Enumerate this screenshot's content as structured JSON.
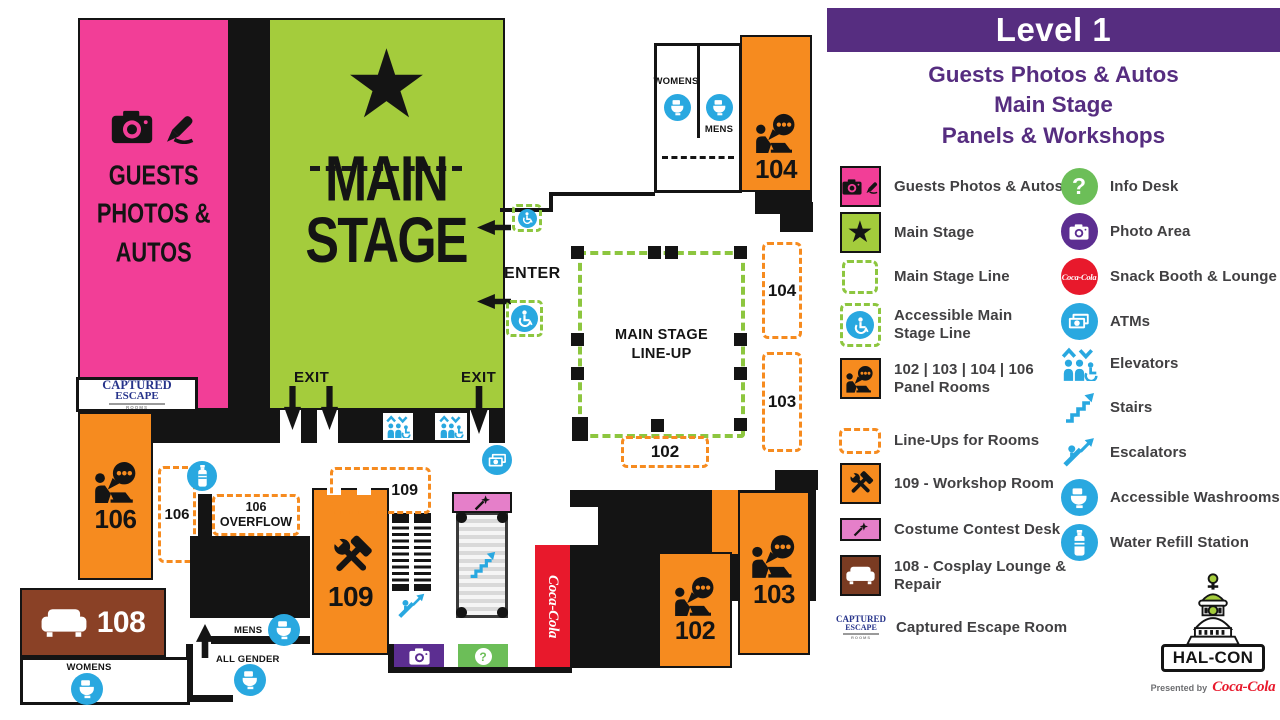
{
  "header": {
    "title": "Level 1",
    "subtitle": "Guests Photos & Autos\nMain Stage\nPanels & Workshops"
  },
  "legend": {
    "left": [
      {
        "icon": "guests-photos-autos",
        "label": "Guests Photos & Autos"
      },
      {
        "icon": "main-stage",
        "label": "Main Stage"
      },
      {
        "icon": "main-stage-line",
        "label": "Main Stage Line"
      },
      {
        "icon": "accessible-main-stage-line",
        "label": "Accessible Main\nStage Line"
      },
      {
        "icon": "panel-rooms",
        "label": "102 | 103 | 104 | 106\nPanel Rooms"
      },
      {
        "icon": "line-ups",
        "label": "Line-Ups for Rooms"
      },
      {
        "icon": "workshop-room",
        "label": "109 - Workshop Room"
      },
      {
        "icon": "costume-contest-desk",
        "label": "Costume Contest Desk"
      },
      {
        "icon": "cosplay-lounge",
        "label": "108 - Cosplay Lounge &\nRepair"
      },
      {
        "icon": "captured-escape",
        "label": "Captured Escape Room"
      }
    ],
    "right": [
      {
        "icon": "info-desk",
        "label": "Info Desk"
      },
      {
        "icon": "photo-area",
        "label": "Photo Area"
      },
      {
        "icon": "snack-booth",
        "label": "Snack Booth & Lounge"
      },
      {
        "icon": "atms",
        "label": "ATMs"
      },
      {
        "icon": "elevators",
        "label": "Elevators"
      },
      {
        "icon": "stairs",
        "label": "Stairs"
      },
      {
        "icon": "escalators",
        "label": "Escalators"
      },
      {
        "icon": "accessible-washrooms",
        "label": "Accessible Washrooms"
      },
      {
        "icon": "water-refill",
        "label": "Water Refill Station"
      }
    ]
  },
  "map": {
    "guests_area": "GUESTS\nPHOTOS &\nAUTOS",
    "main_stage": "MAIN\nSTAGE",
    "enter": "ENTER",
    "exit": "EXIT",
    "lineup": "MAIN STAGE\nLINE-UP",
    "overflow": "106\nOVERFLOW",
    "rooms": {
      "r102": "102",
      "r103": "103",
      "r104": "104",
      "r106": "106",
      "r108": "108",
      "r109": "109"
    },
    "lineups": {
      "l102": "102",
      "l103": "103",
      "l104": "104",
      "l106": "106",
      "l109": "109"
    },
    "washrooms": {
      "womens": "WOMENS",
      "mens": "MENS",
      "all_gender": "ALL GENDER"
    }
  },
  "branding": {
    "halcon": "HAL-CON",
    "presented_by": "Presented by",
    "coca_cola": "Coca-Cola",
    "captured_top": "CAPTURED",
    "captured_bottom": "ESCAPE",
    "captured_rooms": "ROOMS"
  },
  "icons": {
    "star": "★",
    "question_mark": "?"
  },
  "colors": {
    "purple": "#562D80",
    "pink": "#F23E97",
    "green": "#A4CC3C",
    "dash_green": "#8DC63F",
    "orange": "#F68B1F",
    "blue": "#29A8E0",
    "brown": "#8A4126",
    "red": "#E8192C",
    "costume_pink": "#E57FC9",
    "info_green": "#6CBE58",
    "photo_purple": "#5C2E91",
    "black": "#141414"
  }
}
